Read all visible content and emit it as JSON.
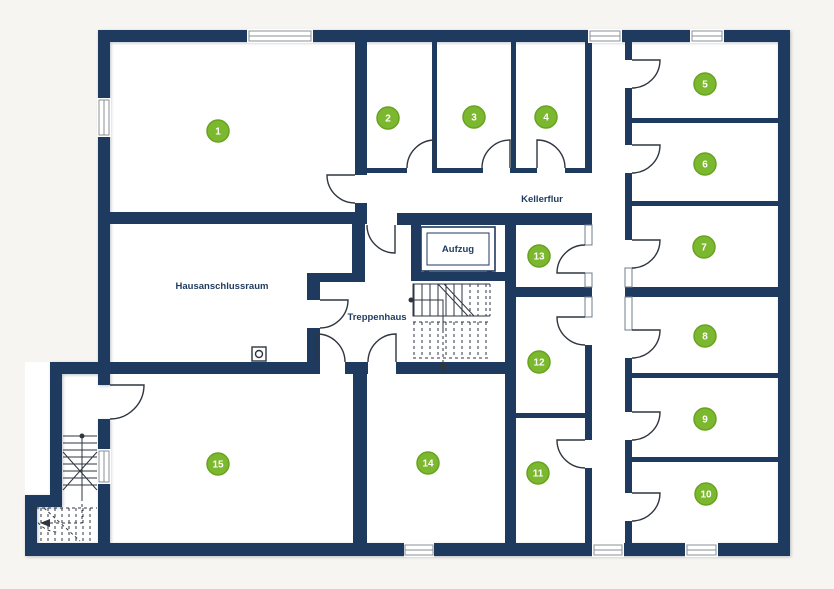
{
  "colors": {
    "background": "#f7f5f1",
    "floor": "#ffffff",
    "wall": "#1e3a5f",
    "line": "#2f3640",
    "window_frame": "#8a9096",
    "badge_fill": "#7cb82f",
    "badge_border": "#68a21f",
    "badge_text": "#ffffff",
    "label_text": "#1e3a5f"
  },
  "labels": {
    "kellerflur": "Kellerflur",
    "aufzug": "Aufzug",
    "treppenhaus": "Treppenhaus",
    "hausanschlussraum": "Hausanschlussraum"
  },
  "rooms": [
    {
      "number": "1"
    },
    {
      "number": "2"
    },
    {
      "number": "3"
    },
    {
      "number": "4"
    },
    {
      "number": "5"
    },
    {
      "number": "6"
    },
    {
      "number": "7"
    },
    {
      "number": "8"
    },
    {
      "number": "9"
    },
    {
      "number": "10"
    },
    {
      "number": "11"
    },
    {
      "number": "12"
    },
    {
      "number": "13"
    },
    {
      "number": "14"
    },
    {
      "number": "15"
    }
  ]
}
